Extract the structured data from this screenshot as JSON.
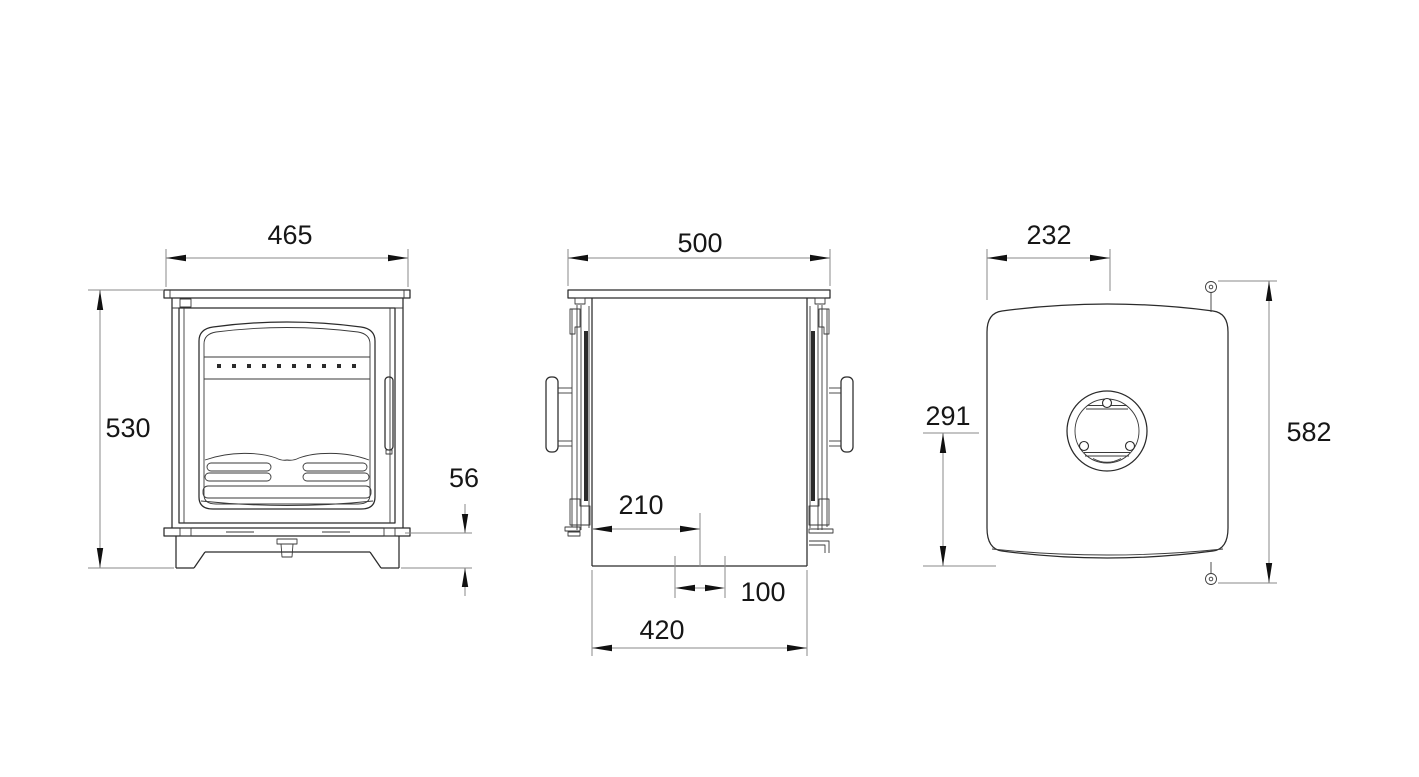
{
  "canvas": {
    "background": "#ffffff",
    "object_line_color": "#2b2b2b",
    "dimension_line_color": "#8a8a8a",
    "text_color": "#161616"
  },
  "drawing": {
    "views": {
      "front": {
        "width": "465",
        "height": "530",
        "base_height": "56"
      },
      "side": {
        "depth": "500",
        "flue_offset_from_front": "210",
        "flue_width": "100",
        "base_depth": "420"
      },
      "top": {
        "flue_center_from_front": "232",
        "flue_center_to_rear": "291",
        "overall_depth": "582"
      }
    }
  }
}
